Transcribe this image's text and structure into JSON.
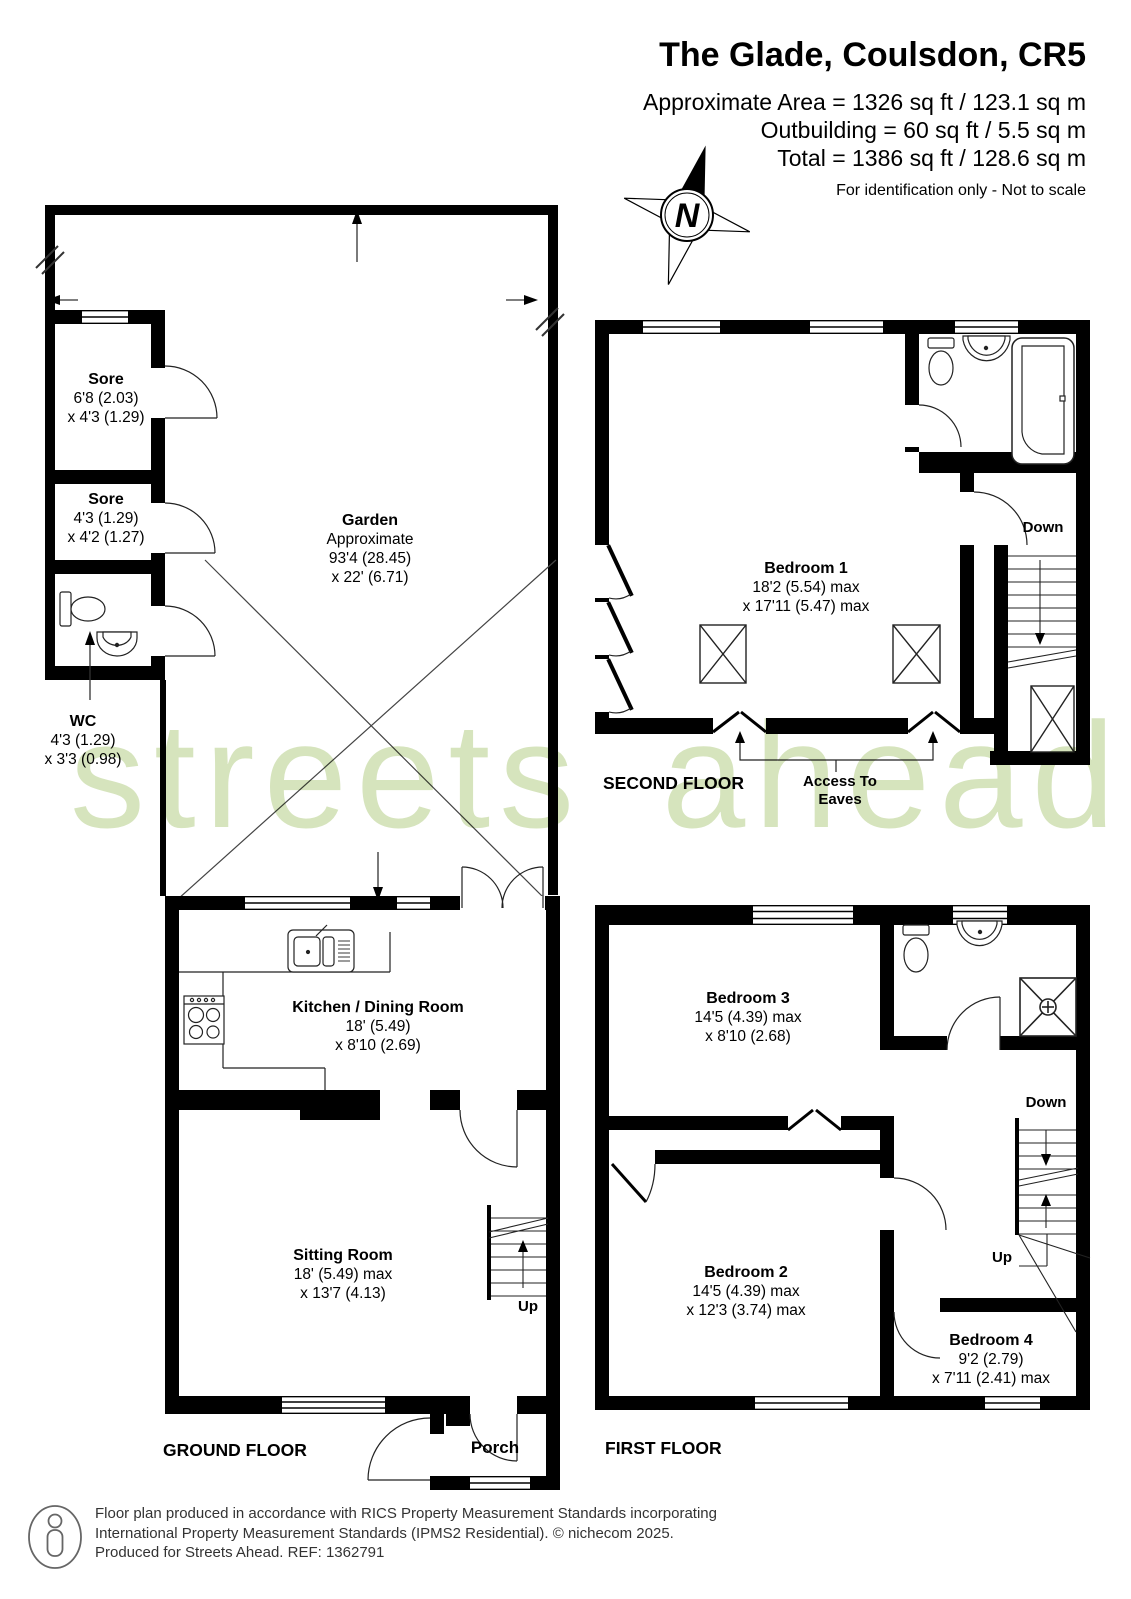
{
  "header": {
    "title": "The Glade, Coulsdon, CR5",
    "area_line": "Approximate Area = 1326 sq ft / 123.1 sq m",
    "outbuilding_line": "Outbuilding = 60 sq ft / 5.5 sq m",
    "total_line": "Total = 1386 sq ft / 128.6 sq m",
    "disclaimer": "For identification only - Not to scale"
  },
  "compass": {
    "label": "N"
  },
  "watermark": {
    "text": "streets ahead"
  },
  "floor_labels": {
    "ground": "GROUND FLOOR",
    "first": "FIRST FLOOR",
    "second": "SECOND FLOOR"
  },
  "rooms": {
    "sore1": {
      "name": "Sore",
      "line1": "6'8 (2.03)",
      "line2": "x 4'3 (1.29)"
    },
    "sore2": {
      "name": "Sore",
      "line1": "4'3 (1.29)",
      "line2": "x 4'2 (1.27)"
    },
    "wc": {
      "name": "WC",
      "line1": "4'3 (1.29)",
      "line2": "x 3'3 (0.98)"
    },
    "garden": {
      "name": "Garden",
      "line0": "Approximate",
      "line1": "93'4 (28.45)",
      "line2": "x 22' (6.71)"
    },
    "kitchen": {
      "name": "Kitchen / Dining Room",
      "line1": "18' (5.49)",
      "line2": "x 8'10 (2.69)"
    },
    "sitting_room": {
      "name": "Sitting Room",
      "line1": "18' (5.49) max",
      "line2": "x 13'7 (4.13)"
    },
    "porch": {
      "name": "Porch"
    },
    "bedroom1": {
      "name": "Bedroom 1",
      "line1": "18'2 (5.54) max",
      "line2": "x 17'11 (5.47) max"
    },
    "bedroom2": {
      "name": "Bedroom 2",
      "line1": "14'5 (4.39) max",
      "line2": "x 12'3 (3.74) max"
    },
    "bedroom3": {
      "name": "Bedroom 3",
      "line1": "14'5 (4.39) max",
      "line2": "x 8'10 (2.68)"
    },
    "bedroom4": {
      "name": "Bedroom 4",
      "line1": "9'2 (2.79)",
      "line2": "x 7'11 (2.41) max"
    }
  },
  "stairs": {
    "up": "Up",
    "down": "Down"
  },
  "annotations": {
    "eaves1": "Access To",
    "eaves2": "Eaves"
  },
  "footer": {
    "line1": "Floor plan produced in accordance with RICS Property Measurement Standards incorporating",
    "line2": "International Property Measurement Standards (IPMS2 Residential).   © nichecom 2025.",
    "line3": "Produced for Streets Ahead.   REF:  1362791"
  },
  "colors": {
    "wall": "#000000",
    "watermark_green": "#d6e4bd",
    "footer_gray": "#333333"
  }
}
